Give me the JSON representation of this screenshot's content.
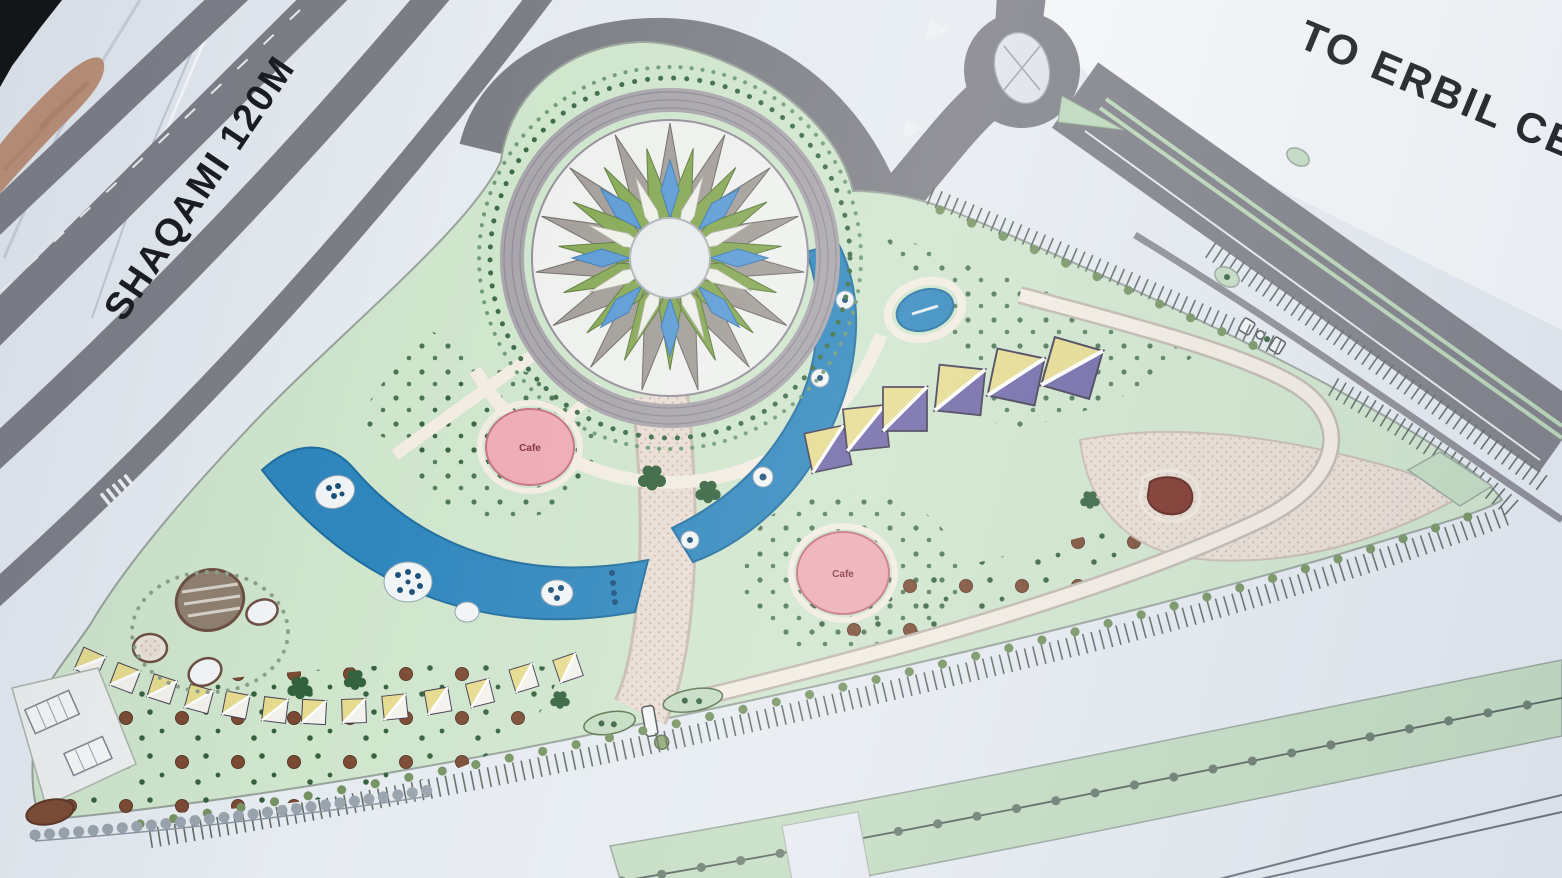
{
  "labels": {
    "left_road": "SHAQAMI 120M",
    "top_right_destination": "TO ERBIL CENT",
    "cafe_a": "Cafe",
    "cafe_b": "Cafe"
  },
  "plan": {
    "colors": {
      "paper": "#e6ebf1",
      "paper_bright": "#f4f6f8",
      "road": "#7d7d85",
      "road_light": "#8b8b93",
      "park": "#cfe5cc",
      "lawn": "#c3dcc1",
      "water": "#2e86bd",
      "water_deep": "#1f6d9e",
      "pave": "#e9ddd4",
      "pave_border": "#c6bbaf",
      "cream": "#f2ece2",
      "cafe": "#edaab4",
      "cafe_text": "#7e2f3a",
      "tent_yellow": "#e6db8e",
      "tent_purple": "#6d66a6",
      "tree_green": "#33613c",
      "tree_brown": "#7a4a33",
      "olive": "#74925f",
      "tick": "#616a64",
      "line": "#6a737d",
      "text": "#17191c",
      "hand_skin": "#bd8f75",
      "hand_shade": "#a97c63",
      "backdrop": "#0e0e0f"
    }
  }
}
